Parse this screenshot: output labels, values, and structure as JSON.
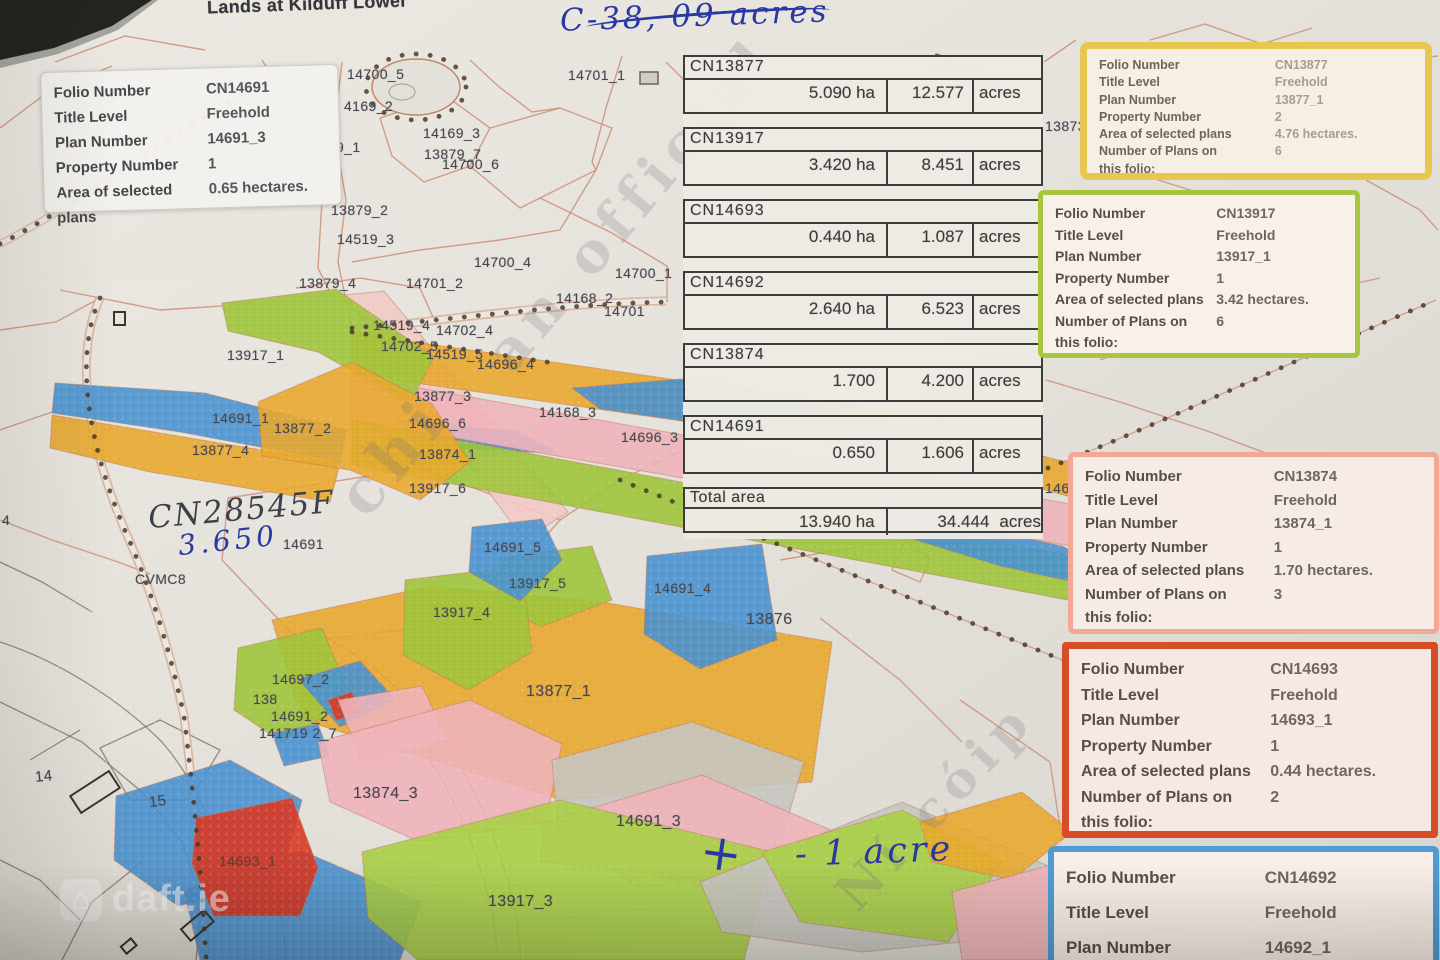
{
  "title": "Lands at Kilduff Lower",
  "annotations": {
    "acreage_note": "C-38, 09 acres",
    "folio_ref": "CN28545F",
    "area_value": "3.650",
    "plus_mark": "+",
    "acre_note": "- 1 acre"
  },
  "watermarks": {
    "fragments": [
      {
        "t": "chi",
        "x": 350,
        "y": 470,
        "rot": -50,
        "size": 62
      },
      {
        "t": "an official",
        "x": 498,
        "y": 330,
        "rot": -50,
        "size": 56
      },
      {
        "t": "Ní cóip",
        "x": 845,
        "y": 872,
        "rot": -47,
        "size": 50
      }
    ],
    "brand": "daft.ie"
  },
  "info_boxes": [
    {
      "name": "CN14691",
      "accent": "",
      "rows": [
        {
          "label": "Folio Number",
          "value": "CN14691"
        },
        {
          "label": "Title Level",
          "value": "Freehold"
        },
        {
          "label": "Plan Number",
          "value": "14691_3"
        },
        {
          "label": "Property Number",
          "value": "1"
        },
        {
          "label": "Area of selected plans",
          "value": "0.65 hectares."
        }
      ]
    },
    {
      "name": "CN13877",
      "accent": "#e8c750",
      "rows": [
        {
          "label": "Folio Number",
          "value": "CN13877"
        },
        {
          "label": "Title Level",
          "value": "Freehold"
        },
        {
          "label": "Plan Number",
          "value": "13877_1"
        },
        {
          "label": "Property Number",
          "value": "2"
        },
        {
          "label": "Area of selected plans",
          "value": "4.76 hectares."
        },
        {
          "label": "Number of Plans on",
          "value": "6"
        },
        {
          "label": "this folio:",
          "value": ""
        }
      ]
    },
    {
      "name": "CN13917",
      "accent": "#a7c63d",
      "rows": [
        {
          "label": "Folio Number",
          "value": "CN13917"
        },
        {
          "label": "Title Level",
          "value": "Freehold"
        },
        {
          "label": "Plan Number",
          "value": "13917_1"
        },
        {
          "label": "Property Number",
          "value": "1"
        },
        {
          "label": "Area of selected plans",
          "value": "3.42 hectares."
        },
        {
          "label": "Number of Plans on",
          "value": "6"
        },
        {
          "label": "this folio:",
          "value": ""
        }
      ]
    },
    {
      "name": "CN13874",
      "accent": "#f3a795",
      "rows": [
        {
          "label": "Folio Number",
          "value": "CN13874"
        },
        {
          "label": "Title Level",
          "value": "Freehold"
        },
        {
          "label": "Plan Number",
          "value": "13874_1"
        },
        {
          "label": "Property Number",
          "value": "1"
        },
        {
          "label": "Area of selected plans",
          "value": "1.70 hectares."
        },
        {
          "label": "Number of Plans on",
          "value": "3"
        },
        {
          "label": "this folio:",
          "value": ""
        }
      ]
    },
    {
      "name": "CN14693",
      "accent": "#d54e28",
      "rows": [
        {
          "label": "Folio Number",
          "value": "CN14693"
        },
        {
          "label": "Title Level",
          "value": "Freehold"
        },
        {
          "label": "Plan Number",
          "value": "14693_1"
        },
        {
          "label": "Property Number",
          "value": "1"
        },
        {
          "label": "Area of selected plans",
          "value": "0.44 hectares."
        },
        {
          "label": "Number of Plans on",
          "value": "2"
        },
        {
          "label": "this folio:",
          "value": ""
        }
      ]
    },
    {
      "name": "CN14692",
      "accent": "#4f9cd4",
      "rows": [
        {
          "label": "Folio Number",
          "value": "CN14692"
        },
        {
          "label": "Title Level",
          "value": "Freehold"
        },
        {
          "label": "Plan Number",
          "value": "14692_1"
        }
      ]
    }
  ],
  "table": {
    "sections": [
      {
        "folio": "CN13877",
        "ha": "5.090 ha",
        "acres": "12.577",
        "unit": "acres"
      },
      {
        "folio": "CN13917",
        "ha": "3.420 ha",
        "acres": "8.451",
        "unit": "acres"
      },
      {
        "folio": "CN14693",
        "ha": "0.440 ha",
        "acres": "1.087",
        "unit": "acres"
      },
      {
        "folio": "CN14692",
        "ha": "2.640 ha",
        "acres": "6.523",
        "unit": "acres"
      },
      {
        "folio": "CN13874",
        "ha": "1.700",
        "acres": "4.200",
        "unit": "acres"
      },
      {
        "folio": "CN14691",
        "ha": "0.650",
        "acres": "1.606",
        "unit": "acres"
      }
    ],
    "total": {
      "label": "Total area",
      "ha": "13.940 ha",
      "acres": "34.444",
      "unit": "acres"
    }
  },
  "map": {
    "labels": [
      {
        "t": "14700_5",
        "x": 347,
        "y": 66
      },
      {
        "t": "4169_2",
        "x": 344,
        "y": 98
      },
      {
        "t": "14169_3",
        "x": 423,
        "y": 125
      },
      {
        "t": "13879_7",
        "x": 424,
        "y": 146
      },
      {
        "t": "14700_6",
        "x": 442,
        "y": 156
      },
      {
        "t": "14701_1",
        "x": 568,
        "y": 67
      },
      {
        "t": "9_1",
        "x": 336,
        "y": 139
      },
      {
        "t": "13879_2",
        "x": 331,
        "y": 202
      },
      {
        "t": "14519_3",
        "x": 337,
        "y": 231
      },
      {
        "t": "13879_4",
        "x": 299,
        "y": 275
      },
      {
        "t": "14701_2",
        "x": 406,
        "y": 275
      },
      {
        "t": "14700_4",
        "x": 474,
        "y": 254
      },
      {
        "t": "14700_1",
        "x": 615,
        "y": 265
      },
      {
        "t": "14168_2",
        "x": 556,
        "y": 290
      },
      {
        "t": "14701",
        "x": 604,
        "y": 303
      },
      {
        "t": "14519_4",
        "x": 373,
        "y": 317
      },
      {
        "t": "14702_4",
        "x": 436,
        "y": 322
      },
      {
        "t": "14702_5",
        "x": 381,
        "y": 338
      },
      {
        "t": "14519_5",
        "x": 426,
        "y": 346
      },
      {
        "t": "14696_4",
        "x": 477,
        "y": 356
      },
      {
        "t": "13917_1",
        "x": 227,
        "y": 347
      },
      {
        "t": "13877_3",
        "x": 414,
        "y": 388
      },
      {
        "t": "14696_6",
        "x": 409,
        "y": 415
      },
      {
        "t": "14168_3",
        "x": 539,
        "y": 404
      },
      {
        "t": "14696_3",
        "x": 621,
        "y": 429
      },
      {
        "t": "14691_1",
        "x": 212,
        "y": 410
      },
      {
        "t": "13877_2",
        "x": 274,
        "y": 420
      },
      {
        "t": "13877_4",
        "x": 192,
        "y": 442
      },
      {
        "t": "13874_1",
        "x": 419,
        "y": 446
      },
      {
        "t": "13917_6",
        "x": 409,
        "y": 480
      },
      {
        "t": "14691",
        "x": 283,
        "y": 536
      },
      {
        "t": "CVMC8",
        "x": 135,
        "y": 571
      },
      {
        "t": "14691_5",
        "x": 484,
        "y": 539
      },
      {
        "t": "13917_5",
        "x": 509,
        "y": 575
      },
      {
        "t": "13917_4",
        "x": 433,
        "y": 604
      },
      {
        "t": "14691_4",
        "x": 654,
        "y": 580
      },
      {
        "t": "13876",
        "x": 746,
        "y": 611,
        "size": 16
      },
      {
        "t": "14697_2",
        "x": 272,
        "y": 671
      },
      {
        "t": "138",
        "x": 253,
        "y": 691
      },
      {
        "t": "14691_2",
        "x": 271,
        "y": 708
      },
      {
        "t": "141719 2_7",
        "x": 259,
        "y": 725
      },
      {
        "t": "13877_1",
        "x": 526,
        "y": 683,
        "size": 16
      },
      {
        "t": "13874_3",
        "x": 353,
        "y": 785,
        "size": 16
      },
      {
        "t": "14691_3",
        "x": 616,
        "y": 813,
        "size": 16
      },
      {
        "t": "14693_1",
        "x": 219,
        "y": 853,
        "color": "#6b3a34"
      },
      {
        "t": "13917_3",
        "x": 488,
        "y": 893,
        "size": 16
      },
      {
        "t": "14",
        "x": 35,
        "y": 768,
        "size": 15,
        "rot": -6
      },
      {
        "t": "15",
        "x": 149,
        "y": 793,
        "size": 15,
        "rot": -8
      },
      {
        "t": "13873_",
        "x": 1045,
        "y": 118
      },
      {
        "t": "146",
        "x": 1045,
        "y": 480
      },
      {
        "t": "4",
        "x": 2,
        "y": 512
      }
    ]
  }
}
